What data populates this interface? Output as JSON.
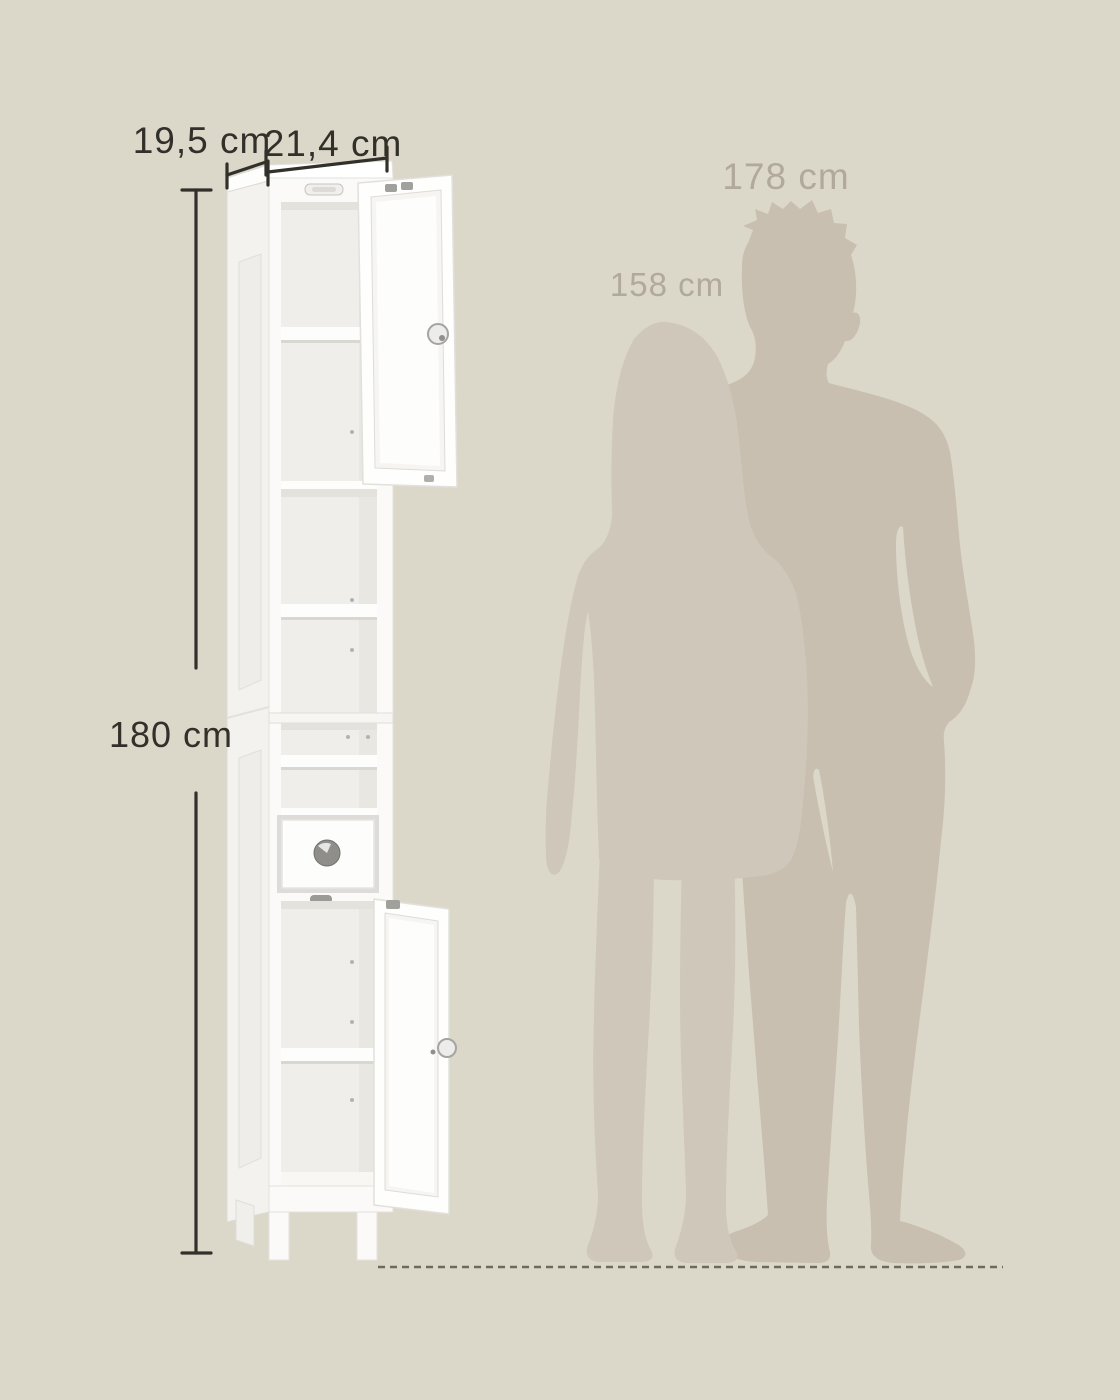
{
  "scene": {
    "description": "Size illustration of a tall narrow bathroom cabinet with open doors, compared to two standing human silhouettes over a dashed ground line"
  },
  "colors": {
    "background": "#dcd8c9",
    "ink": "#32302a",
    "muted_label": "#b1a99b",
    "ground_line": "#6f6a5e",
    "silhouette_back": "#c8bfb1",
    "silhouette_front": "#cfc8ba",
    "cabinet_face": "#fbfaf8",
    "cabinet_side": "#f3f2ef",
    "cabinet_interior": "#efeeea",
    "cabinet_top": "#fdfdfc"
  },
  "dimensions": {
    "depth": {
      "label": "19,5 cm"
    },
    "width": {
      "label": "21,4 cm"
    },
    "height": {
      "label": "180 cm"
    }
  },
  "reference_people": [
    {
      "id": "woman",
      "height_label": "158 cm"
    },
    {
      "id": "man",
      "height_label": "178 cm"
    }
  ]
}
